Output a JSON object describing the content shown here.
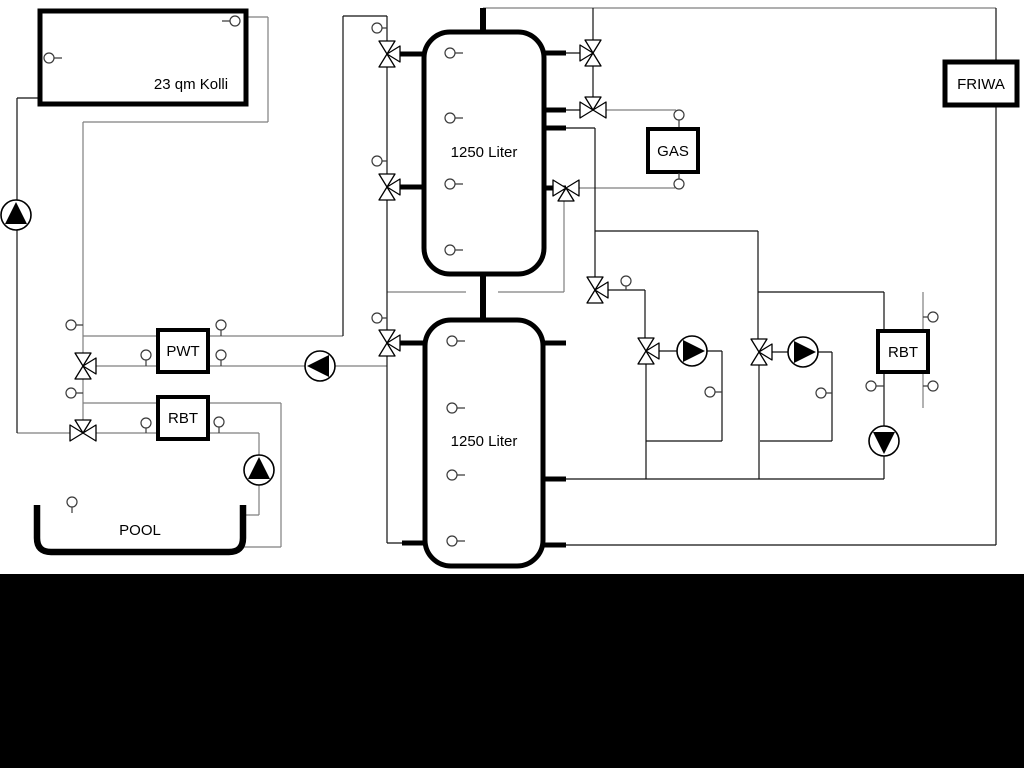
{
  "diagram": {
    "collector": {
      "label": "23 qm Kolli"
    },
    "buffer_tank_top": {
      "label": "1250 Liter"
    },
    "buffer_tank_bottom": {
      "label": "1250 Liter"
    },
    "heat_exchanger": {
      "label": "PWT"
    },
    "pool_boiler": {
      "label": "RBT"
    },
    "right_boiler": {
      "label": "RBT"
    },
    "gas_boiler": {
      "label": "GAS"
    },
    "fresh_water_station": {
      "label": "FRIWA"
    },
    "pool": {
      "label": "POOL"
    },
    "colors": {
      "line_light": "#7f7f7f",
      "line_dark": "#111111",
      "component_stroke": "#000000",
      "background": "#ffffff",
      "bottom_bar": "#000000"
    }
  }
}
